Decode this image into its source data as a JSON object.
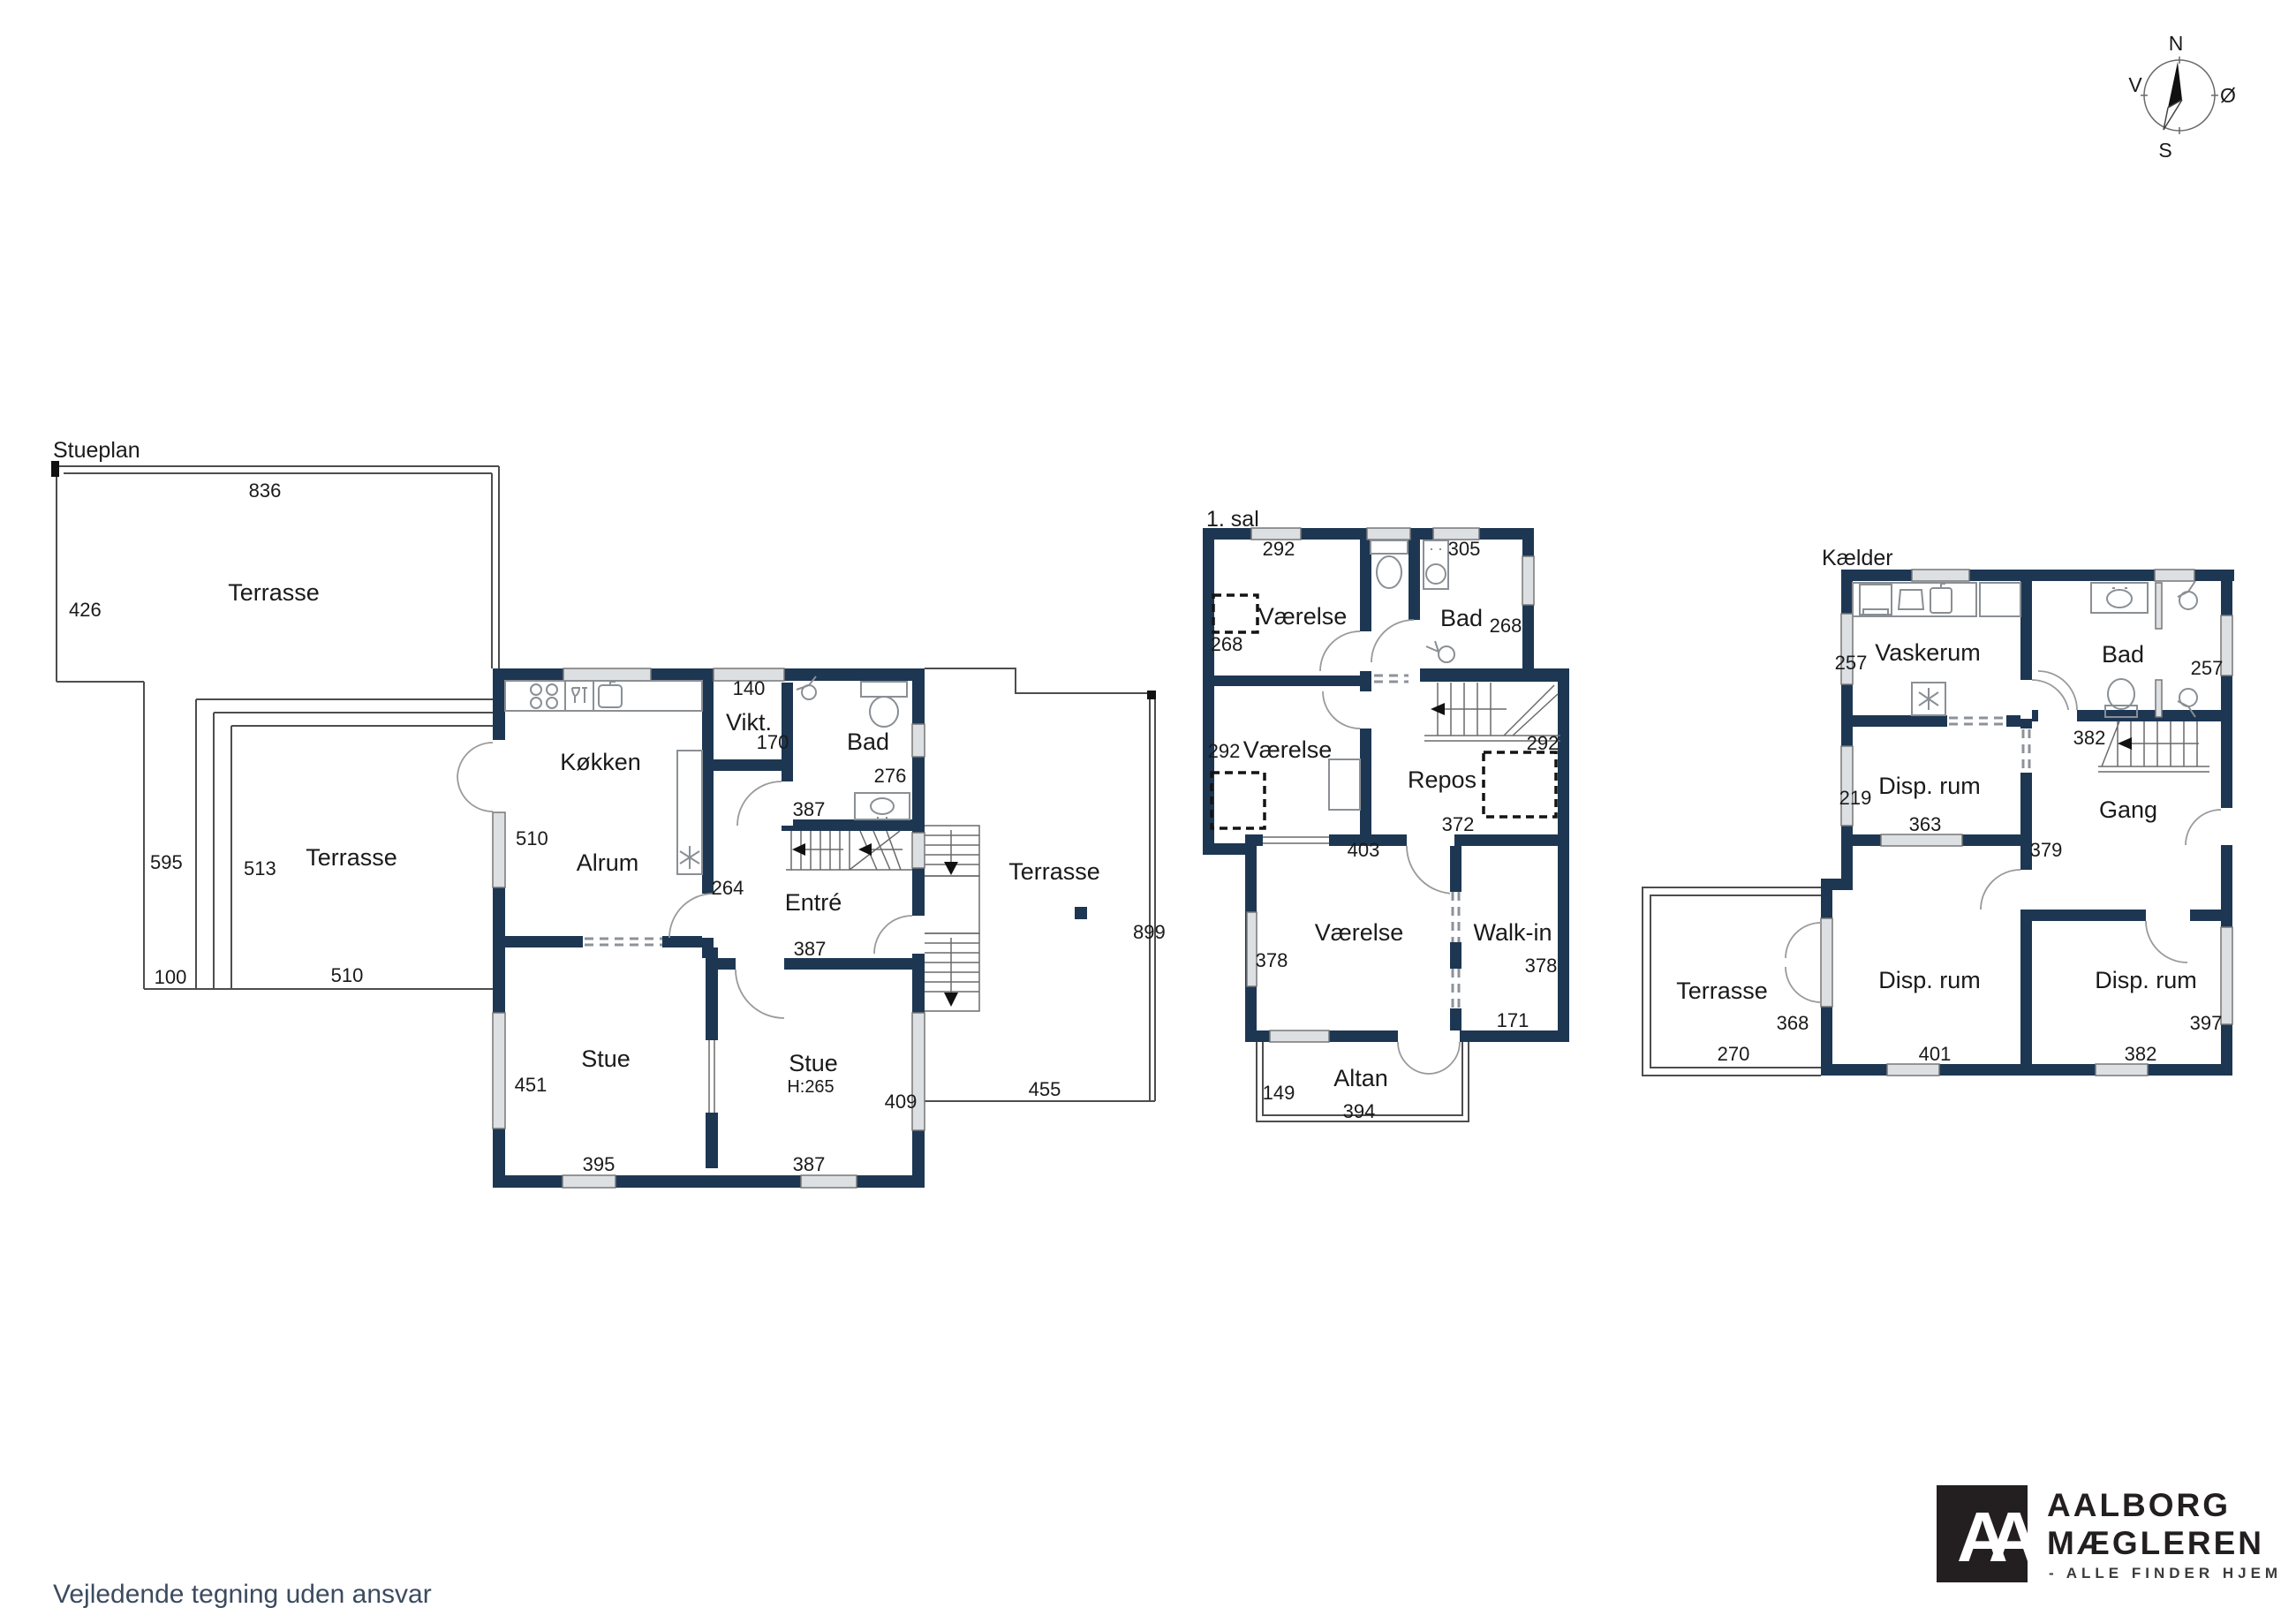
{
  "floors": {
    "stueplan": {
      "title": "Stueplan",
      "rooms": {
        "terrasse_top": "Terrasse",
        "terrasse_left": "Terrasse",
        "terrasse_right": "Terrasse",
        "koekken": "Køkken",
        "alrum": "Alrum",
        "vikt": "Vikt.",
        "bad": "Bad",
        "entre": "Entré",
        "stue1": "Stue",
        "stue2": "Stue",
        "stue2_height": "H:265"
      },
      "meas": {
        "m836": "836",
        "m426": "426",
        "m595": "595",
        "m513": "513",
        "m100": "100",
        "m510_terrasse": "510",
        "m510_wall": "510",
        "m140": "140",
        "m170": "170",
        "m276": "276",
        "m387_bad": "387",
        "m264": "264",
        "m387_entre": "387",
        "m451": "451",
        "m395": "395",
        "m387_stue": "387",
        "m409": "409",
        "m455": "455",
        "m899": "899"
      }
    },
    "sal1": {
      "title": "1. sal",
      "rooms": {
        "vaerelse1": "Værelse",
        "bad": "Bad",
        "vaerelse2": "Værelse",
        "repos": "Repos",
        "vaerelse3": "Værelse",
        "walkin": "Walk-in",
        "altan": "Altan"
      },
      "meas": {
        "m292a": "292",
        "m305": "305",
        "m268l": "268",
        "m268r": "268",
        "m292b": "292",
        "m292c": "292",
        "m403": "403",
        "m372": "372",
        "m378l": "378",
        "m378r": "378",
        "m171": "171",
        "m149": "149",
        "m394": "394"
      }
    },
    "kaelder": {
      "title": "Kælder",
      "rooms": {
        "vaskerum": "Vaskerum",
        "bad": "Bad",
        "disp1": "Disp. rum",
        "gang": "Gang",
        "terrasse": "Terrasse",
        "disp2": "Disp. rum",
        "disp3": "Disp. rum"
      },
      "meas": {
        "m257l": "257",
        "m257r": "257",
        "m219": "219",
        "m363": "363",
        "m382s": "382",
        "m379": "379",
        "m368": "368",
        "m270": "270",
        "m401": "401",
        "m382b": "382",
        "m397": "397"
      }
    }
  },
  "compass": {
    "n": "N",
    "e": "Ø",
    "s": "S",
    "w": "V"
  },
  "footer": {
    "disclaimer": "Vejledende tegning uden ansvar"
  },
  "logo": {
    "monogram": "AA",
    "line1": "AALBORG",
    "line2": "MÆGLEREN",
    "tagline": "- ALLE FINDER HJEM"
  },
  "colors": {
    "wall": "#1d3753",
    "line": "#4d4d4d",
    "window": "#dde0e3",
    "disclaimer_text": "#3c4b60",
    "logo": "#231f20"
  }
}
